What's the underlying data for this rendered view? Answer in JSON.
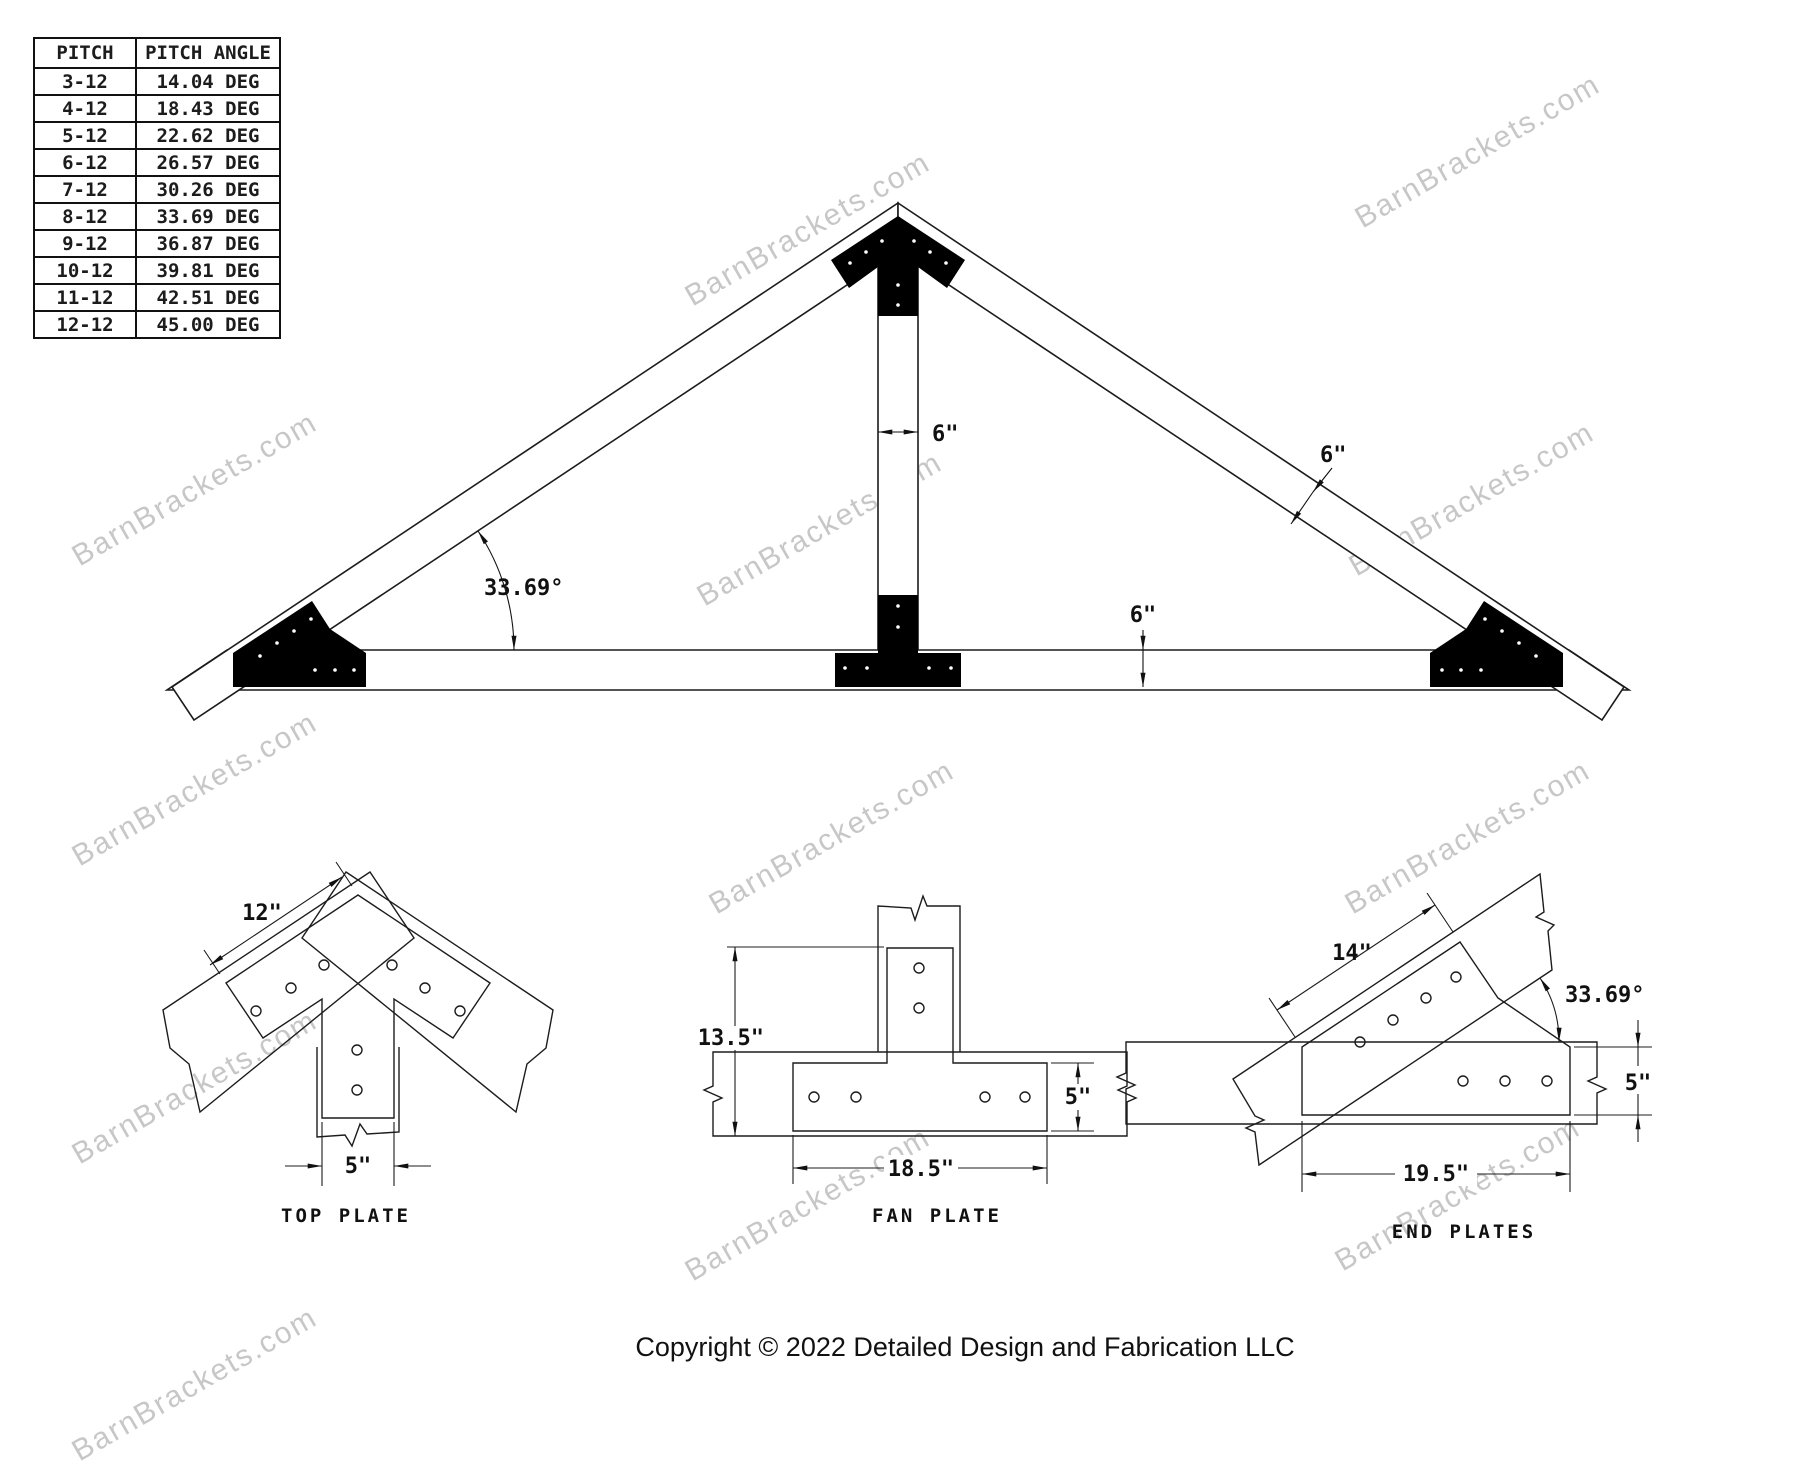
{
  "watermark": {
    "text": "BarnBrackets.com"
  },
  "pitch_table": {
    "headers": [
      "PITCH",
      "PITCH ANGLE"
    ],
    "rows": [
      [
        "3-12",
        "14.04 DEG"
      ],
      [
        "4-12",
        "18.43 DEG"
      ],
      [
        "5-12",
        "22.62 DEG"
      ],
      [
        "6-12",
        "26.57 DEG"
      ],
      [
        "7-12",
        "30.26 DEG"
      ],
      [
        "8-12",
        "33.69 DEG"
      ],
      [
        "9-12",
        "36.87 DEG"
      ],
      [
        "10-12",
        "39.81 DEG"
      ],
      [
        "11-12",
        "42.51 DEG"
      ],
      [
        "12-12",
        "45.00 DEG"
      ]
    ]
  },
  "truss": {
    "king_post_width": "6\"",
    "rafter_depth": "6\"",
    "chord_depth": "6\"",
    "pitch_angle": "33.69°"
  },
  "details": {
    "top_plate": {
      "label": "TOP PLATE",
      "wing_length": "12\"",
      "stem_width": "5\""
    },
    "fan_plate": {
      "label": "FAN PLATE",
      "overall_height": "13.5\"",
      "base_length": "18.5\"",
      "plate_width": "5\""
    },
    "end_plates": {
      "label": "END PLATES",
      "rafter_leg_length": "14\"",
      "pitch_angle": "33.69°",
      "plate_width": "5\"",
      "chord_leg_length": "19.5\""
    }
  },
  "footer": {
    "copyright": "Copyright © 2022 Detailed Design and Fabrication LLC"
  }
}
